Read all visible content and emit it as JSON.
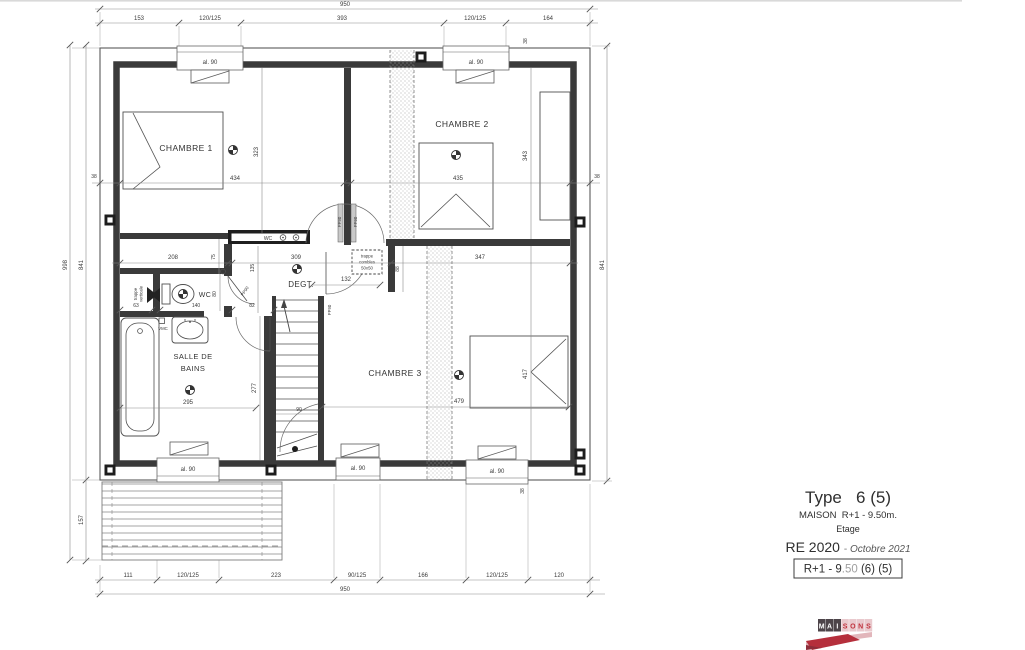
{
  "plan": {
    "rooms": {
      "chambre1": "CHAMBRE 1",
      "chambre2": "CHAMBRE 2",
      "chambre3": "CHAMBRE 3",
      "sdb1": "SALLE DE",
      "sdb2": "BAINS",
      "wc": "WC",
      "degt": "DEGT."
    },
    "labels": {
      "al90": "al. 90",
      "wc_closet": "WC",
      "vmc": "VMC",
      "pp90": "PP90",
      "trappe1": "trappe",
      "trappe2": "combles",
      "trappe3": "50x50",
      "tv1": "trappe",
      "tv2": "verticale"
    },
    "dims": {
      "top_total": "950",
      "top1": "153",
      "top2": "120/125",
      "top3": "393",
      "top4": "120/125",
      "top5": "164",
      "bot1": "111",
      "bot2": "120/125",
      "bot3": "223",
      "bot4": "90/125",
      "bot5": "166",
      "bot6": "120/125",
      "bot7": "120",
      "bot_total": "950",
      "left_outer": "998",
      "left_inner": "841",
      "terrace": "157",
      "right": "841",
      "wall_l": "38",
      "wall_r": "38",
      "wall_tr": "38",
      "wall_br": "38",
      "c1w": "434",
      "c1h": "323",
      "c2w": "435",
      "c2h": "343",
      "c2b": "347",
      "c3w": "479",
      "c3h": "417",
      "d208": "208",
      "d309": "309",
      "d132": "132",
      "d88": "88",
      "d75": "75",
      "d135": "135",
      "d63": "63",
      "d140": "140",
      "d82": "82",
      "d80": "80",
      "sdbw": "295",
      "sdbh": "277",
      "stair": "90"
    }
  },
  "title_block": {
    "type_line": "Type   6 (5)",
    "maison_line": "MAISON  R+1 - 9.50m.",
    "etage_line": "Etage",
    "re_label": "RE 2020 ",
    "re_sep": "- ",
    "re_date": "Octobre 2021",
    "ref_prefix": "R+1 - 9",
    "ref_gray": ".50",
    "ref_suffix": " (6) (5)"
  },
  "logo": {
    "letters": [
      "M",
      "A",
      "I",
      "S",
      "O",
      "N",
      "S"
    ]
  }
}
